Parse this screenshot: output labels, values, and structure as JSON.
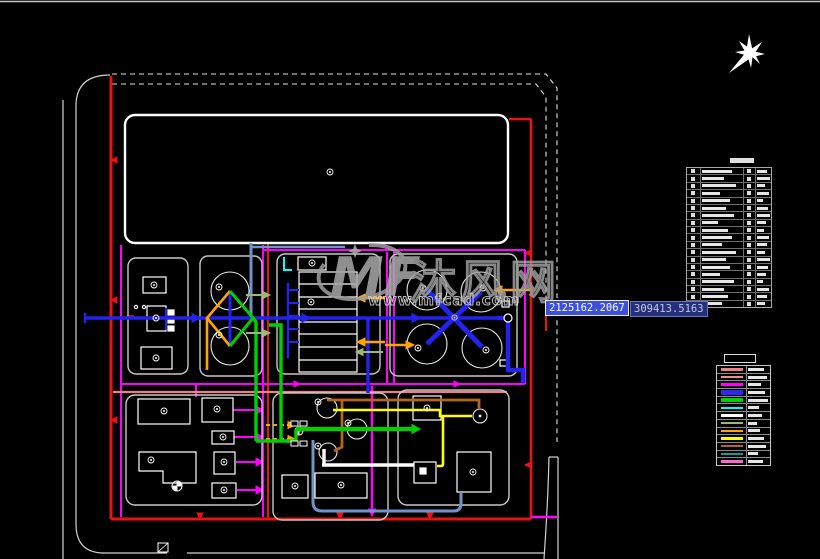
{
  "canvas": {
    "w": 820,
    "h": 559,
    "bg": "#000000",
    "top_border": "#c8c8c8"
  },
  "tooltips": {
    "x": {
      "value": "2125162.2067",
      "bg": "#3c50dc",
      "border": "#e8e8e8",
      "text_color": "#ffffff"
    },
    "y": {
      "value": "309413.5163",
      "bg": "#25307d",
      "border": "#6874b8",
      "text_color": "#c2c8e2"
    }
  },
  "watermark": {
    "logo_text": "MF",
    "brand": "沐风网",
    "url": "www.mfcad.com",
    "color": "#9f9f9f"
  },
  "north_arrow": {
    "icon": "eight-point-star",
    "color": "#ffffff"
  },
  "equipment_legend": {
    "border": "#a8a8a8",
    "rows": [
      {
        "w1": 30,
        "w2": 10
      },
      {
        "w1": 22,
        "w2": 13
      },
      {
        "w1": 34,
        "w2": 8
      },
      {
        "w1": 18,
        "w2": 12
      },
      {
        "w1": 28,
        "w2": 6
      },
      {
        "w1": 24,
        "w2": 11
      },
      {
        "w1": 32,
        "w2": 13
      },
      {
        "w1": 16,
        "w2": 9
      },
      {
        "w1": 26,
        "w2": 7
      },
      {
        "w1": 30,
        "w2": 12
      },
      {
        "w1": 20,
        "w2": 10
      },
      {
        "w1": 34,
        "w2": 8
      },
      {
        "w1": 24,
        "w2": 13
      },
      {
        "w1": 28,
        "w2": 11
      },
      {
        "w1": 18,
        "w2": 9
      },
      {
        "w1": 32,
        "w2": 6
      },
      {
        "w1": 22,
        "w2": 12
      },
      {
        "w1": 26,
        "w2": 10
      },
      {
        "w1": 20,
        "w2": 8
      }
    ]
  },
  "pipe_legend": {
    "border": "#c8c8c8",
    "rows": [
      {
        "color": "#f08080",
        "w": 16,
        "thick": false
      },
      {
        "color": "#ef8f7f",
        "w": 19,
        "thick": false
      },
      {
        "color": "#ff00ff",
        "w": 13,
        "thick": false
      },
      {
        "color": "#2a2aee",
        "w": 17,
        "thick": true
      },
      {
        "color": "#00d000",
        "w": 20,
        "thick": true
      },
      {
        "color": "#00ffff",
        "w": 11,
        "thick": false
      },
      {
        "color": "#ffffff",
        "w": 14,
        "thick": false
      },
      {
        "color": "#9cb974",
        "w": 9,
        "thick": false
      },
      {
        "color": "#ffa500",
        "w": 12,
        "thick": false
      },
      {
        "color": "#ffff00",
        "w": 16,
        "thick": false
      },
      {
        "color": "#b5651d",
        "w": 18,
        "thick": false
      },
      {
        "color": "#0f9b8e",
        "w": 10,
        "thick": false
      },
      {
        "color": "#ff66cc",
        "w": 15,
        "thick": false
      }
    ]
  },
  "palette": {
    "red": "#e81313",
    "salmon": "#f08080",
    "magenta": "#ff00ff",
    "blue": "#2323ee",
    "steel_blue": "#7094c8",
    "green": "#00d000",
    "pale_green": "#9cb974",
    "cyan": "#00ffff",
    "orange": "#ffa500",
    "brown": "#b5651d",
    "yellow": "#ffff00",
    "white": "#ffffff",
    "gray_border": "#c8c8c8"
  }
}
